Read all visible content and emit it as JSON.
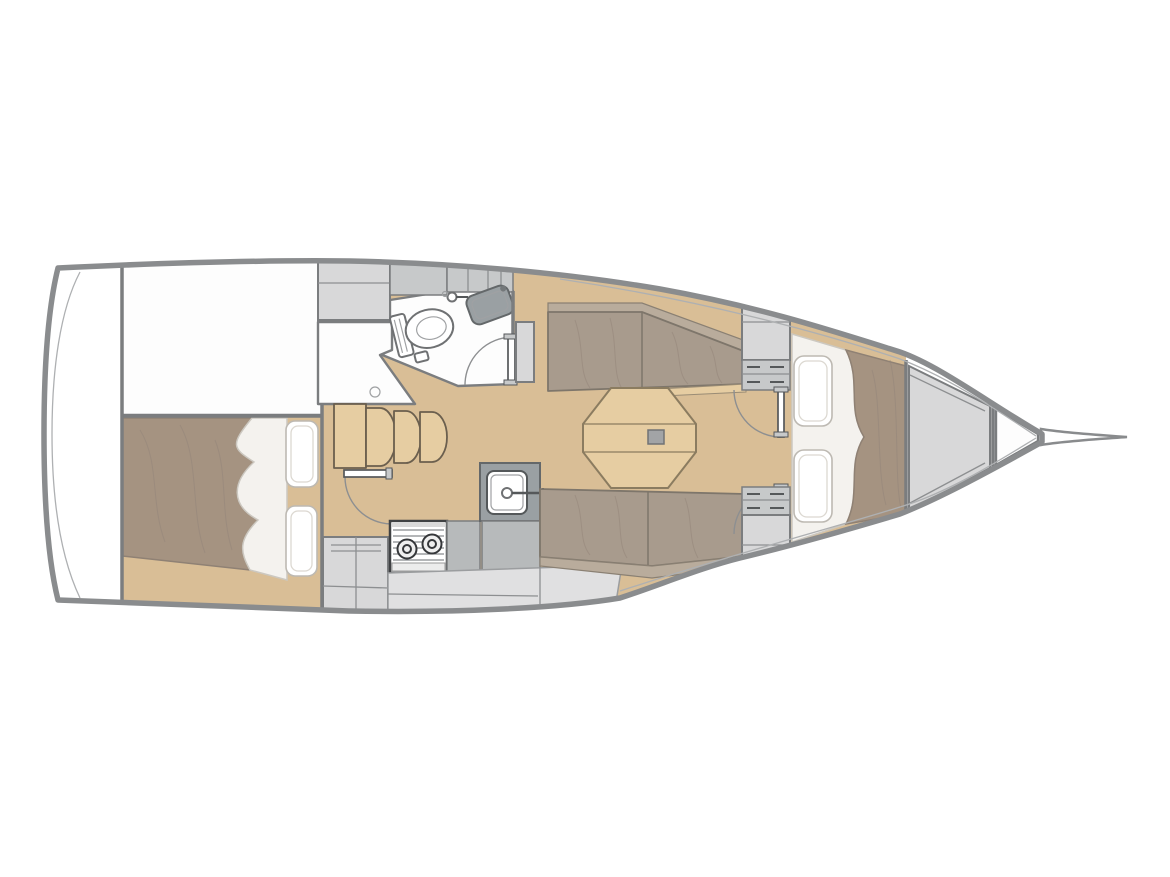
{
  "figure": {
    "kind": "sailboat-interior-floor-plan",
    "view": "top-down",
    "bow_direction": "right",
    "alt": "Sailboat interior layout plan, bow pointing right"
  },
  "palette": {
    "hull_stroke": "#8a8c8e",
    "wall": "#7b7d7f",
    "white": "#ffffff",
    "floor_white": "#fdfdfd",
    "wood_floor": "#d9be96",
    "wood_light": "#e6cda2",
    "cushion": "#a89b8d",
    "cushion_light": "#b9ac9c",
    "cushion_edge": "#7e766b",
    "mattress": "#a59381",
    "linen": "#f4f2ee",
    "linen_shade": "#ccc8c0",
    "grey_light": "#d8d8d9",
    "grey_mid": "#c7c9ca",
    "grey_dark": "#9aa0a3",
    "grey_panel": "#b7babb",
    "counter_light": "#e0e0e1"
  },
  "areas": {
    "transom": "Transom platform",
    "aft_cabin": "Aft double cabin",
    "technical": "Cockpit / technical space",
    "head": "Head with toilet, washbasin and shower",
    "steps": "Companionway steps",
    "galley": "Galley with stove and sink",
    "saloon": "Saloon with settees and folding table",
    "fwd_bulkhead": "Forward cabin double doors and lockers",
    "fwd_cabin": "Forward V-berth cabin",
    "anchor": "Anchor locker",
    "forepeak": "Forepeak compartment",
    "bowsprit": "Bowsprit"
  },
  "fixtures": {
    "toilet": "Toilet",
    "washbasin": "Washbasin",
    "shower_drain": "Shower drain",
    "stove": "Two-burner stove",
    "galley_sink": "Galley sink",
    "table": "Folding saloon table",
    "table_leg": "Table pedestal",
    "pillow": "Pillow",
    "door": "Door"
  }
}
